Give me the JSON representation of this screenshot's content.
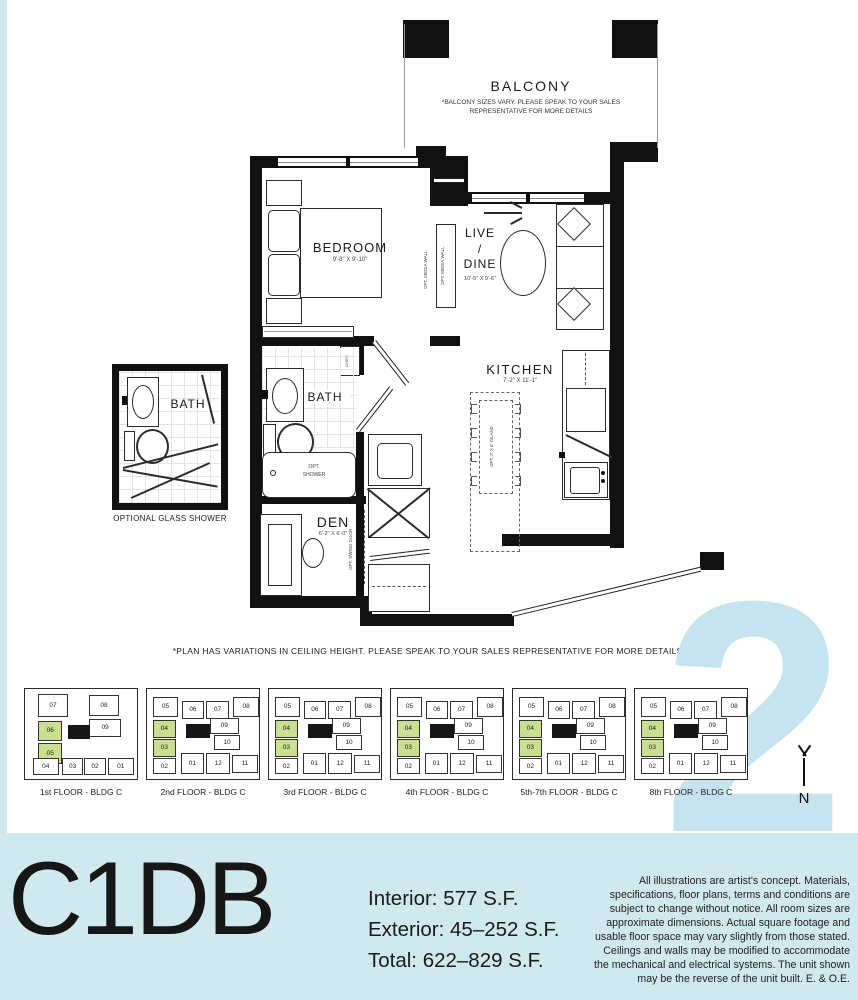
{
  "plan": {
    "balcony": {
      "label": "BALCONY",
      "note": "*BALCONY SIZES VARY. PLEASE SPEAK TO YOUR SALES REPRESENTATIVE FOR MORE DETAILS"
    },
    "rooms": {
      "bedroom": {
        "label": "BEDROOM",
        "dims": "9'-8\" X 9'-10\""
      },
      "live_dine": {
        "label": "LIVE\n/\nDINE",
        "dims": "10'-5\" X 9'-6\""
      },
      "kitchen": {
        "label": "KITCHEN",
        "dims": "7'-2\" X 11'-1\""
      },
      "bath": {
        "label": "BATH"
      },
      "den": {
        "label": "DEN",
        "dims": "6'-2\" X 6'-0\""
      }
    },
    "annotations": {
      "media_wall": "OPT. MEDIA WALL",
      "island": "OPT. 2' X 6' ISLAND",
      "swing_door": "OPT. SWING DOOR",
      "opt_shower": "OPT.\nSHOWER",
      "linen": "LINEN",
      "inset_bath": "BATH",
      "inset_caption": "OPTIONAL GLASS SHOWER"
    },
    "footnote": "*PLAN HAS VARIATIONS IN CEILING HEIGHT. PLEASE SPEAK TO YOUR SALES REPRESENTATIVE FOR MORE DETAILS."
  },
  "keyplans": {
    "watermark": "2",
    "north_label": "N",
    "highlight_color": "#cbdf90",
    "floors": [
      {
        "caption": "1st FLOOR - BLDG C",
        "layout": "A"
      },
      {
        "caption": "2nd FLOOR - BLDG C",
        "layout": "B"
      },
      {
        "caption": "3rd FLOOR - BLDG C",
        "layout": "B"
      },
      {
        "caption": "4th FLOOR - BLDG C",
        "layout": "B"
      },
      {
        "caption": "5th-7th FLOOR - BLDG C",
        "layout": "B"
      },
      {
        "caption": "8th FLOOR - BLDG C",
        "layout": "B"
      }
    ],
    "layouts": {
      "A": [
        {
          "n": "07",
          "x": 12,
          "y": 5,
          "w": 26,
          "h": 26
        },
        {
          "n": "08",
          "x": 57,
          "y": 7,
          "w": 27,
          "h": 23
        },
        {
          "n": "06",
          "x": 12,
          "y": 35,
          "w": 21,
          "h": 23,
          "g": true
        },
        {
          "n": "09",
          "x": 57,
          "y": 33,
          "w": 29,
          "h": 20
        },
        {
          "n": "05",
          "x": 12,
          "y": 60,
          "w": 21,
          "h": 23,
          "g": true
        },
        {
          "n": "04",
          "x": 7,
          "y": 77,
          "w": 23,
          "h": 19
        },
        {
          "n": "03",
          "x": 33,
          "y": 77,
          "w": 19,
          "h": 19
        },
        {
          "n": "02",
          "x": 53,
          "y": 77,
          "w": 19,
          "h": 19
        },
        {
          "n": "01",
          "x": 74,
          "y": 77,
          "w": 23,
          "h": 19
        },
        {
          "core": true,
          "x": 38,
          "y": 40,
          "w": 20,
          "h": 16
        }
      ],
      "B": [
        {
          "n": "05",
          "x": 5,
          "y": 9,
          "w": 23,
          "h": 22
        },
        {
          "n": "06",
          "x": 31,
          "y": 13,
          "w": 20,
          "h": 20
        },
        {
          "n": "07",
          "x": 53,
          "y": 13,
          "w": 20,
          "h": 20
        },
        {
          "n": "08",
          "x": 77,
          "y": 9,
          "w": 23,
          "h": 22
        },
        {
          "n": "04",
          "x": 5,
          "y": 34,
          "w": 21,
          "h": 20,
          "g": true
        },
        {
          "n": "09",
          "x": 56,
          "y": 32,
          "w": 26,
          "h": 18
        },
        {
          "n": "03",
          "x": 5,
          "y": 55,
          "w": 21,
          "h": 20,
          "g": true
        },
        {
          "n": "10",
          "x": 60,
          "y": 51,
          "w": 23,
          "h": 17
        },
        {
          "n": "02",
          "x": 5,
          "y": 77,
          "w": 21,
          "h": 18
        },
        {
          "n": "01",
          "x": 30,
          "y": 71,
          "w": 21,
          "h": 23
        },
        {
          "n": "12",
          "x": 53,
          "y": 71,
          "w": 21,
          "h": 23
        },
        {
          "n": "11",
          "x": 76,
          "y": 73,
          "w": 23,
          "h": 20
        },
        {
          "core": true,
          "x": 35,
          "y": 39,
          "w": 21,
          "h": 15
        }
      ]
    }
  },
  "footer": {
    "unit_name": "C1DB",
    "stats": [
      "Interior: 577 S.F.",
      "Exterior: 45–252 S.F.",
      "Total: 622–829 S.F."
    ],
    "disclaimer": "All illustrations are artist's concept. Materials, specifications, floor plans, terms and conditions are subject to change without notice. All room sizes are approximate dimensions. Actual square footage and usable floor space may vary slightly from those stated. Ceilings and walls may be modified to accommodate the mechanical and electrical systems. The unit shown may be the reverse of the unit built. E. & O.E.",
    "band_color": "#cfe9ee"
  }
}
